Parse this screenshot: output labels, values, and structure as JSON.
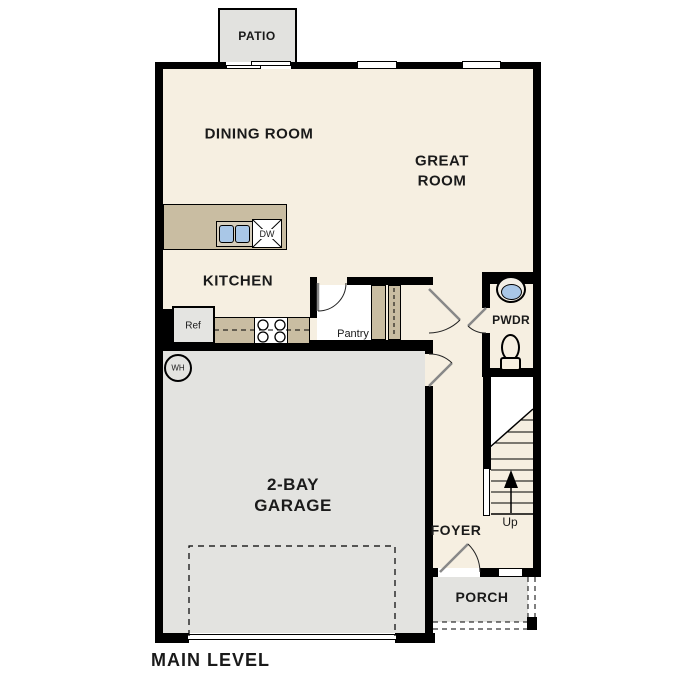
{
  "title": "MAIN LEVEL",
  "labels": {
    "patio": "PATIO",
    "dining_room": "DINING ROOM",
    "great_room_line1": "GREAT",
    "great_room_line2": "ROOM",
    "kitchen": "KITCHEN",
    "powder_room": "PWDR",
    "pantry": "Pantry",
    "garage_line1": "2-BAY",
    "garage_line2": "GARAGE",
    "foyer": "FOYER",
    "porch": "PORCH",
    "stairs_up": "Up"
  },
  "fixtures": {
    "refrigerator": "Ref",
    "dishwasher": "DW",
    "water_heater": "WH"
  },
  "colors": {
    "wall": "#000000",
    "floor_beige": "#f6efe1",
    "hardscape_gray": "#e3e3e0",
    "cabinet_tan": "#c9bda2",
    "sink_blue": "#a9c7e7",
    "pantry_white": "#ffffff"
  }
}
